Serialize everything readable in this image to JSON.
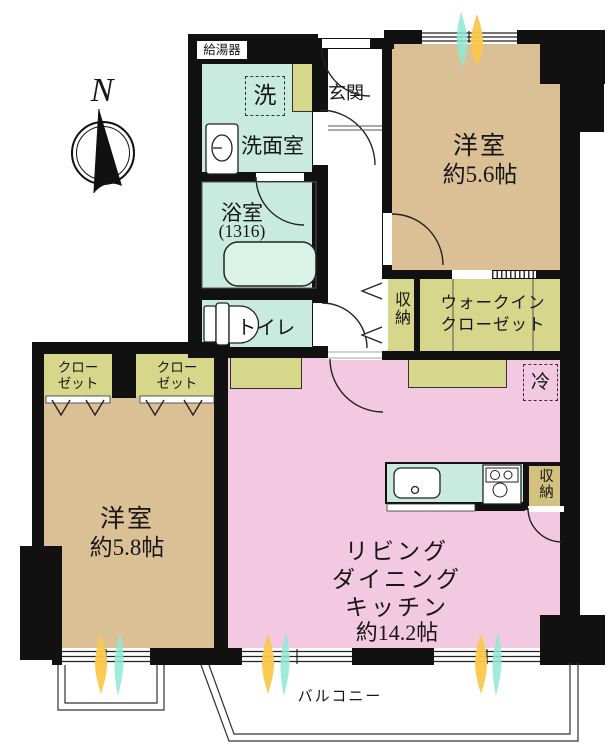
{
  "compass": {
    "north_label": "N"
  },
  "equipment": {
    "water_heater": "給湯器",
    "washing_machine": "洗",
    "refrigerator": "冷"
  },
  "rooms": {
    "entrance": {
      "name": "玄関"
    },
    "washroom": {
      "name": "洗面室"
    },
    "bathroom": {
      "name": "浴室",
      "size": "(1316)"
    },
    "toilet": {
      "name": "トイレ"
    },
    "bedroom1": {
      "name": "洋室",
      "size": "約5.6帖"
    },
    "hall_storage": {
      "name": "収納"
    },
    "walkin_closet": {
      "name_line1": "ウォークイン",
      "name_line2": "クローゼット"
    },
    "closet_left": {
      "name_line1": "クロー",
      "name_line2": "ゼット"
    },
    "closet_right": {
      "name_line1": "クロー",
      "name_line2": "ゼット"
    },
    "bedroom2": {
      "name": "洋室",
      "size": "約5.8帖"
    },
    "ldk": {
      "name_line1": "リビング",
      "name_line2": "ダイニング",
      "name_line3": "キッチン",
      "size": "約14.2帖"
    },
    "kitchen_storage": {
      "name": "収納"
    },
    "balcony": {
      "name": "バルコニー"
    }
  },
  "colors": {
    "wall": "#111111",
    "wet_room": "#C9EBDF",
    "bedroom": "#DCC095",
    "closet": "#D6D78A",
    "ldk": "#F3C9E2",
    "kitchen_storage": "#D3C27E",
    "sunlight_yellow": "#FBC84B",
    "sunlight_teal": "#8FE9D4"
  }
}
